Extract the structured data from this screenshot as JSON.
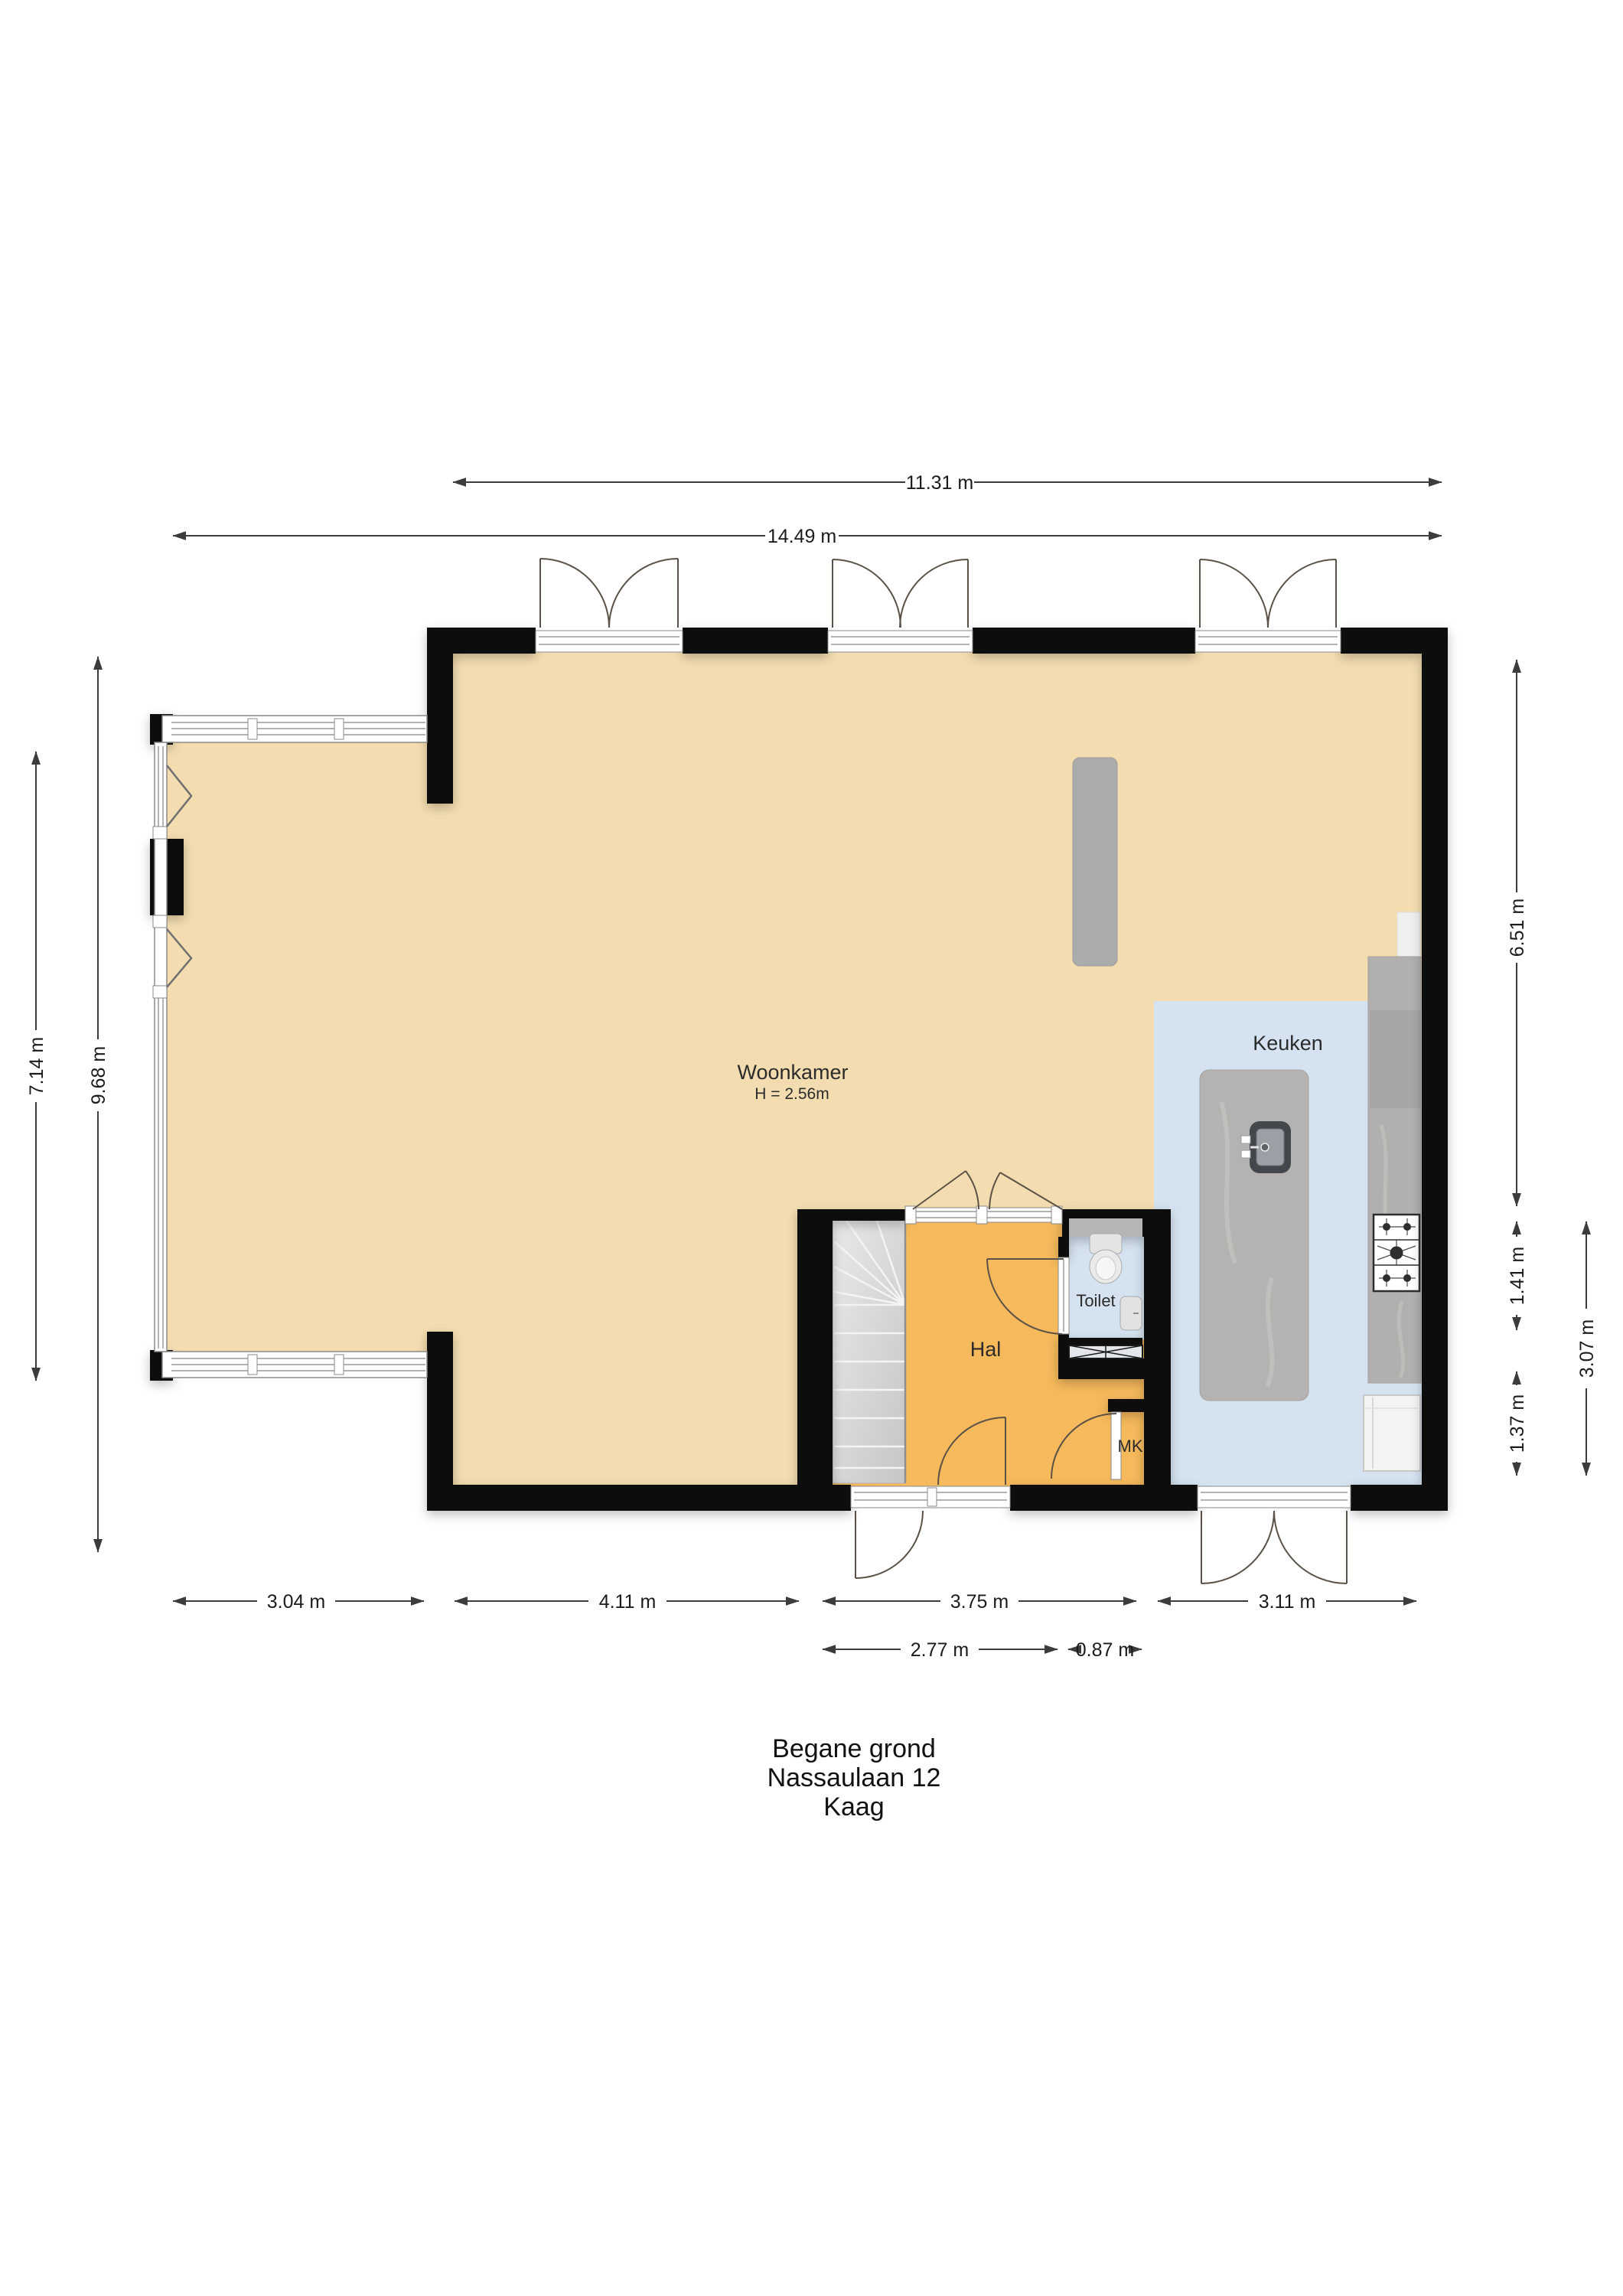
{
  "plan": {
    "title_lines": [
      "Begane grond",
      "Nassaulaan 12",
      "Kaag"
    ]
  },
  "rooms": {
    "living_room": {
      "label": "Woonkamer",
      "ceiling_height": "H = 2.56m"
    },
    "kitchen": {
      "label": "Keuken"
    },
    "hall": {
      "label": "Hal"
    },
    "toilet": {
      "label": "Toilet"
    },
    "meter_cupboard": {
      "label": "MK"
    }
  },
  "dimensions": {
    "top_inner": "11.31 m",
    "top_outer": "14.49 m",
    "left_inner": "7.14 m",
    "left_outer": "9.68 m",
    "right_living": "6.51 m",
    "right_toilet": "1.41 m",
    "right_meter": "1.37 m",
    "right_total": "3.07 m",
    "bottom_bay": "3.04 m",
    "bottom_living": "4.11 m",
    "bottom_hall": "3.75 m",
    "bottom_kitchen": "3.11 m",
    "bottom_hall_inner": "2.77 m",
    "bottom_toilet": "0.87 m"
  },
  "colors": {
    "wall": "#0f0f0f",
    "floor_living": "#f3ddb0",
    "floor_hall": "#f6b95b",
    "floor_wet": "#d5e3f0",
    "counter": "#b2b0ae",
    "island": "#b5b3b1",
    "dim_line": "#3c3c3c",
    "text": "#1b1b1b"
  }
}
